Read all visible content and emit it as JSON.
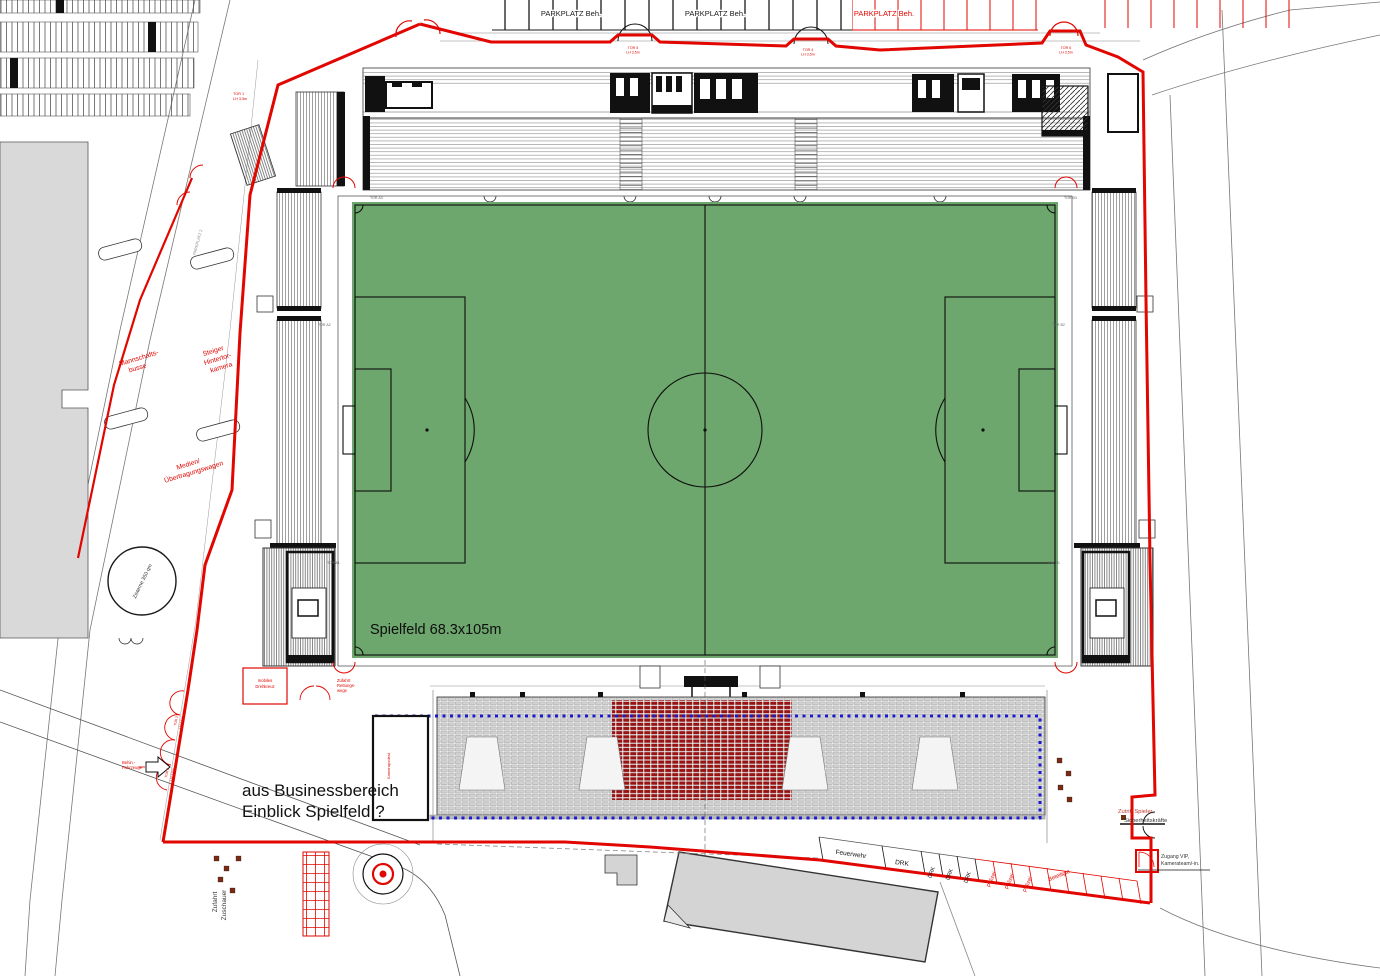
{
  "colors": {
    "boundary_red": "#e10600",
    "pitch_green": "#6da76d",
    "seat_maroon": "#9b1212",
    "overlay_blue": "#1a1acc"
  },
  "parking_top": {
    "label1": "PARKPLATZ Beh.",
    "label2": "PARKPLATZ Beh.",
    "label3": "PARKPLATZ Beh."
  },
  "gates": {
    "tor1": {
      "name": "TOR 1",
      "clearance": "LH 3,5m"
    },
    "tor2": {
      "name": "TOR 2",
      "clearance": "LH 3,5m"
    },
    "tor3": {
      "name": "TOR 3",
      "clearance": "LH 3,5m"
    },
    "tor4": {
      "name": "TOR 4",
      "clearance": "LH 3,5m"
    },
    "tor5": {
      "name": "TOR 5",
      "clearance": "LH 3,5m"
    },
    "tor6": {
      "name": "TOR 6",
      "clearance": "LH 3,5m"
    }
  },
  "west_area": {
    "bus_l1": "Mannschafts-",
    "bus_l2": "busse",
    "steiger_l1": "Steiger",
    "steiger_l2": "Hintertor-",
    "steiger_l3": "kamera",
    "medien_l1": "Medien/",
    "medien_l2": "Übertragungswagen",
    "zisterne": "Zisterne 350 qm",
    "parkplatz_small": "PARKPLATZ 2"
  },
  "pitch": {
    "label": "Spielfeld 68.3x105m"
  },
  "south_area": {
    "business_l1": "aus Businessbereich",
    "business_l2": "Einblick Spielfeld ?",
    "camera_box": "Kamerapodest",
    "zufahrt_l1": "Zufahrt",
    "zufahrt_l2": "Zuschauer",
    "drehkreuz_l1": "mobiles",
    "drehkreuz_l2": "Drehkreuz",
    "rettung_l1": "Zufahrt",
    "rettung_l2": "Rettungs-",
    "rettung_l3": "wege",
    "behinderte_l1": "Behin.-",
    "behinderte_l2": "Fahrzeuge"
  },
  "service_parking": {
    "feuerwehr": "Feuerwehr",
    "drk": "DRK",
    "polizei": "Polizei",
    "beteiligte": "Beteiligte"
  },
  "access": {
    "zutritt_l1": "Zutritt Spieler,",
    "zutritt_l2": "Sicherheitskräfte",
    "zugang_l1": "Zugang VIP,",
    "zugang_l2": "Kamerateam/-in."
  },
  "stand_gates": {
    "a1": "TOR A1",
    "a2": "TOR A2",
    "a3": "TOR A3",
    "b1": "TOR B1",
    "b2": "TOR B2",
    "b3": "TOR B3"
  }
}
